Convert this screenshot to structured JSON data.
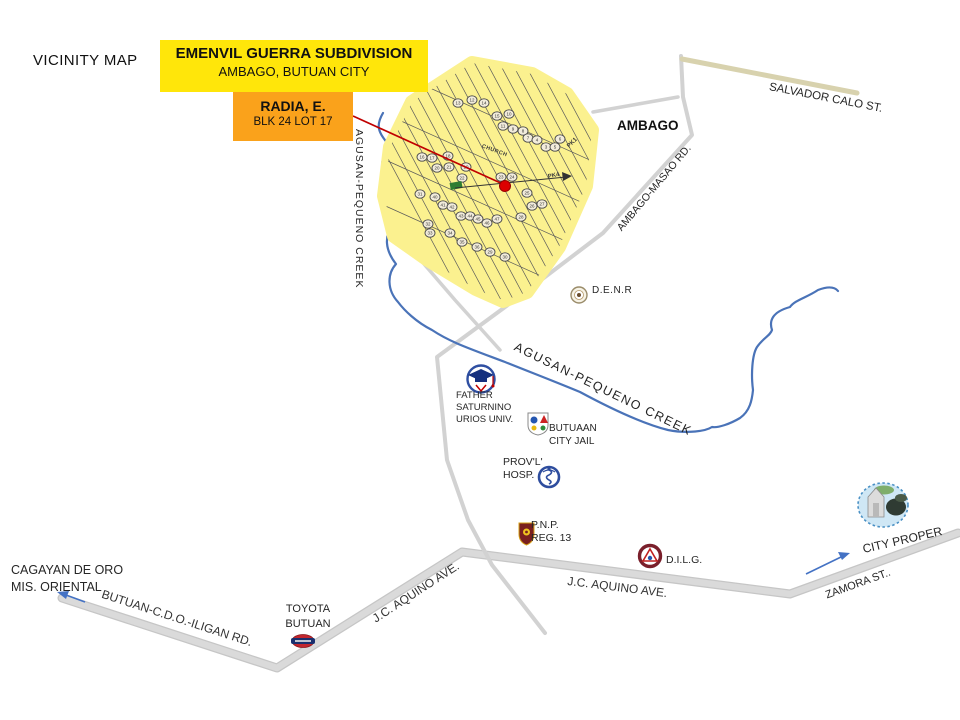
{
  "title": "VICINITY MAP",
  "callouts": {
    "subdivision": {
      "line1": "EMENVIL GUERRA SUBDIVISION",
      "line2": "AMBAGO, BUTUAN CITY"
    },
    "lot": {
      "line1": "RADIA, E.",
      "line2": "BLK 24 LOT 17"
    }
  },
  "areas": {
    "ambago": "AMBAGO",
    "city_proper": "CITY PROPER",
    "cagayan_line1": "CAGAYAN DE ORO",
    "cagayan_line2": "MIS. ORIENTAL"
  },
  "roads": {
    "salvador_calo": "SALVADOR CALO ST.",
    "ambago_masao": "AMBAGO-MASAO RD.",
    "jc_aquino_east": "J.C. AQUINO AVE.",
    "jc_aquino_west": "J.C. AQUINO AVE.",
    "butuan_cdo_iligan": "BUTUAN-C.D.O.-ILIGAN  RD.",
    "zamora": "ZAMORA ST.."
  },
  "waterways": {
    "creek_west": "AGUSAN-PEQUENO  CREEK",
    "creek_main": "AGUSAN-PEQUENO  CREEK"
  },
  "places": {
    "denr": "D.E.N.R",
    "fsuu_line1": "FATHER",
    "fsuu_line2": "SATURNINO",
    "fsuu_line3": "URIOS UNIV.",
    "jail_line1": "BUTUAAN",
    "jail_line2": "CITY JAIL",
    "hosp_line1": "PROV'L'",
    "hosp_line2": "HOSP.",
    "pnp_line1": "P.N.P.",
    "pnp_line2": "REG. 13",
    "dilg": "D.I.L.G.",
    "toyota_line1": "TOYOTA",
    "toyota_line2": "BUTUAN"
  },
  "subdivision_map": {
    "church": "CHURCH",
    "pk1": "PK1",
    "pk4": "PK4",
    "block_markers": [
      {
        "x": 458,
        "y": 103,
        "n": 13
      },
      {
        "x": 472,
        "y": 100,
        "n": 12
      },
      {
        "x": 484,
        "y": 103,
        "n": 14
      },
      {
        "x": 497,
        "y": 116,
        "n": 15
      },
      {
        "x": 509,
        "y": 114,
        "n": 10
      },
      {
        "x": 503,
        "y": 126,
        "n": 11
      },
      {
        "x": 513,
        "y": 129,
        "n": 9
      },
      {
        "x": 523,
        "y": 131,
        "n": 8
      },
      {
        "x": 528,
        "y": 138,
        "n": 7
      },
      {
        "x": 537,
        "y": 140,
        "n": 4
      },
      {
        "x": 546,
        "y": 147,
        "n": 3
      },
      {
        "x": 555,
        "y": 147,
        "n": 5
      },
      {
        "x": 560,
        "y": 139,
        "n": 6
      },
      {
        "x": 422,
        "y": 157,
        "n": 16
      },
      {
        "x": 432,
        "y": 158,
        "n": 17
      },
      {
        "x": 448,
        "y": 156,
        "n": 18
      },
      {
        "x": 437,
        "y": 168,
        "n": 20
      },
      {
        "x": 449,
        "y": 167,
        "n": 21
      },
      {
        "x": 466,
        "y": 167,
        "n": 19
      },
      {
        "x": 462,
        "y": 178,
        "n": 22
      },
      {
        "x": 501,
        "y": 177,
        "n": 23
      },
      {
        "x": 512,
        "y": 177,
        "n": 24
      },
      {
        "x": 527,
        "y": 193,
        "n": 25
      },
      {
        "x": 532,
        "y": 206,
        "n": 26
      },
      {
        "x": 542,
        "y": 204,
        "n": 27
      },
      {
        "x": 521,
        "y": 217,
        "n": 28
      },
      {
        "x": 420,
        "y": 194,
        "n": 31
      },
      {
        "x": 435,
        "y": 197,
        "n": 40
      },
      {
        "x": 443,
        "y": 205,
        "n": 41
      },
      {
        "x": 452,
        "y": 207,
        "n": 42
      },
      {
        "x": 461,
        "y": 216,
        "n": 43
      },
      {
        "x": 470,
        "y": 216,
        "n": 44
      },
      {
        "x": 478,
        "y": 219,
        "n": 45
      },
      {
        "x": 487,
        "y": 223,
        "n": 46
      },
      {
        "x": 497,
        "y": 219,
        "n": 47
      },
      {
        "x": 428,
        "y": 224,
        "n": 32
      },
      {
        "x": 430,
        "y": 233,
        "n": 33
      },
      {
        "x": 450,
        "y": 233,
        "n": 34
      },
      {
        "x": 462,
        "y": 242,
        "n": 35
      },
      {
        "x": 477,
        "y": 247,
        "n": 36
      },
      {
        "x": 490,
        "y": 252,
        "n": 29
      },
      {
        "x": 505,
        "y": 257,
        "n": 30
      }
    ]
  },
  "colors": {
    "title_yellow": "#ffe60a",
    "callout_orange": "#faa21b",
    "subdivision_fill": "#fbf18f",
    "road_grey": "#dadada",
    "road_edge": "#c6c6c6",
    "beige_road": "#d8d2ae",
    "creek_blue": "#4a73b8",
    "callout_red": "#c00000",
    "marker_dot_red": "#dd0000",
    "arrow_blue": "#4472c4"
  }
}
